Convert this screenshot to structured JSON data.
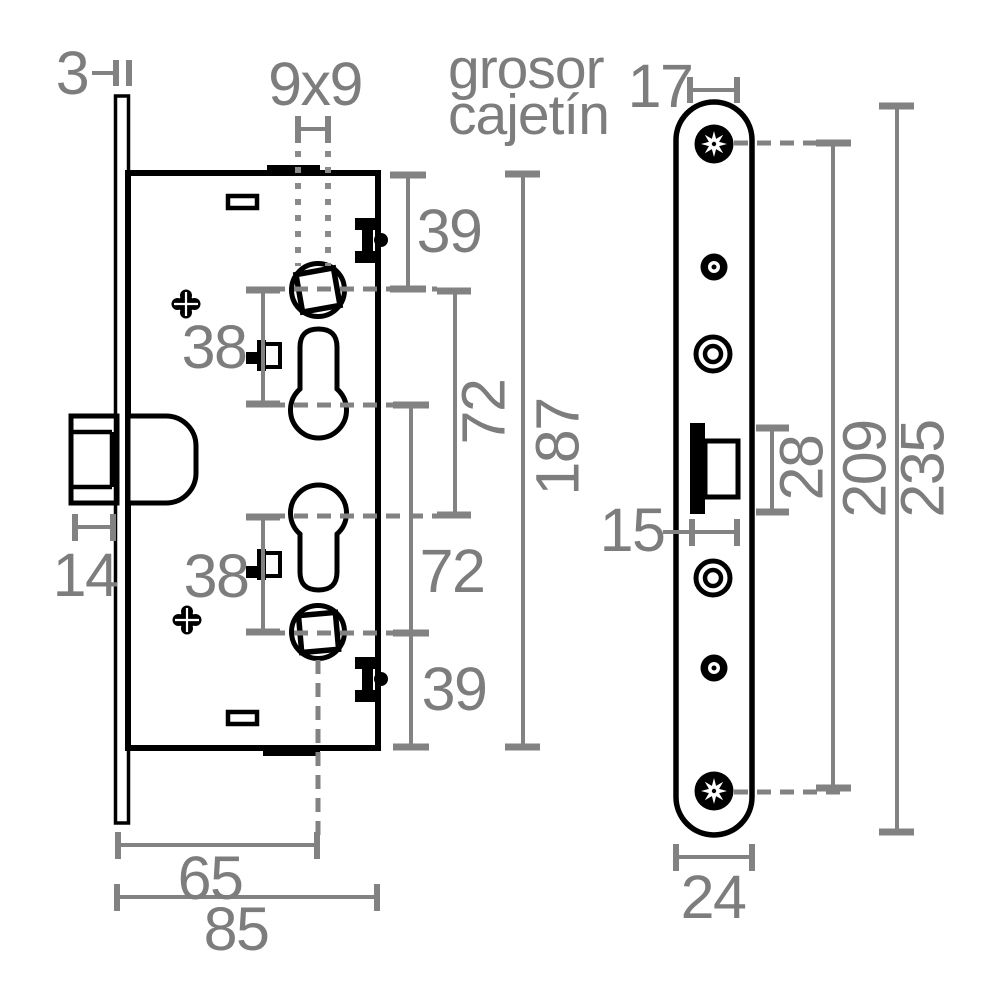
{
  "drawing": {
    "note": {
      "line1": "grosor",
      "line2": "cajetín"
    },
    "side_view": {
      "faceplate_thickness": "3",
      "spindle_square": "9x9",
      "top_to_spindle": "39",
      "spindle_to_cylinder_upper": "38",
      "upper_axis_span": "72",
      "case_height": "187",
      "cylinder_to_spindle_lower": "38",
      "lower_axis_span": "72",
      "spindle_to_bottom": "39",
      "latch_projection": "14",
      "backset": "65",
      "case_depth": "85"
    },
    "front_view": {
      "edge_to_screw": "17",
      "latch_width": "15",
      "latch_height": "28",
      "screw_centers": "209",
      "plate_length": "235",
      "plate_width": "24"
    },
    "colors": {
      "linework": "#000000",
      "dimension": "#828282"
    }
  }
}
